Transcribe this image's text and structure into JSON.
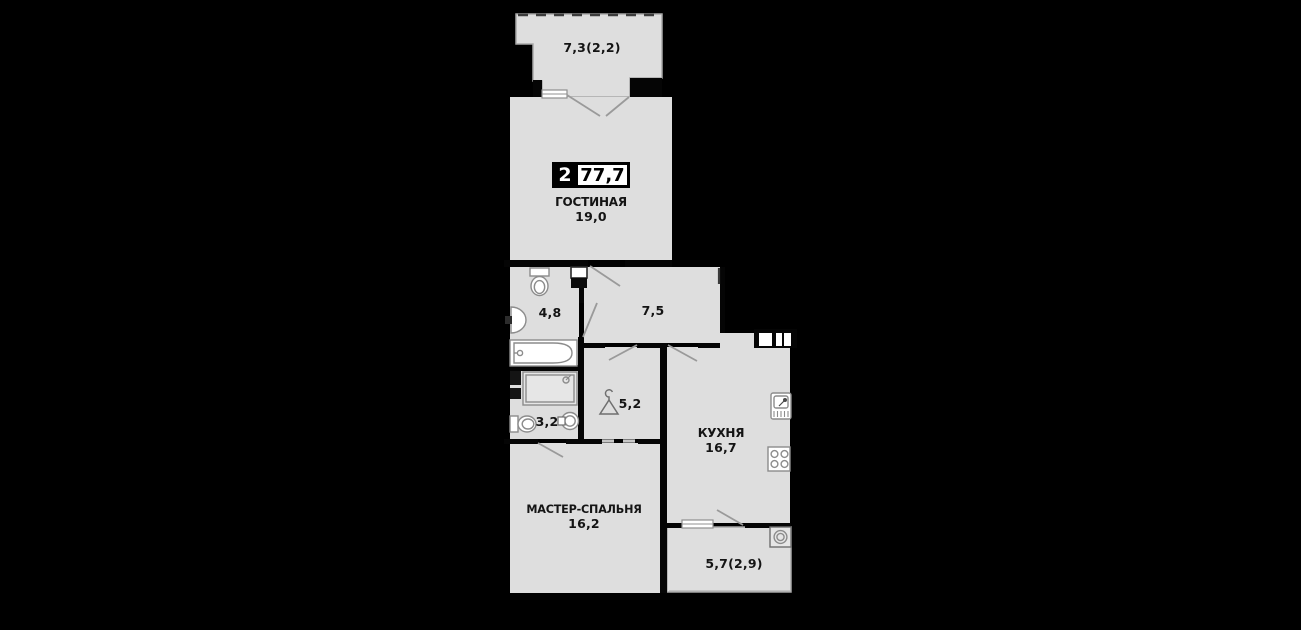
{
  "title_badge": {
    "rooms_count": "2",
    "total_area": "77,7"
  },
  "rooms": {
    "balcony_top": {
      "area": "7,3(2,2)",
      "fixtures": [
        "french-window"
      ]
    },
    "living": {
      "name": "ГОСТИНАЯ",
      "area": "19,0"
    },
    "bathroom": {
      "area": "4,8",
      "fixtures": [
        "toilet",
        "sink",
        "bathtub",
        "vent-shaft"
      ]
    },
    "hallway": {
      "area": "7,5",
      "fixtures": [
        "entrance-door"
      ]
    },
    "shower_room": {
      "area": "3,2",
      "fixtures": [
        "shower-tray",
        "toilet",
        "sink",
        "water-heater"
      ]
    },
    "wardrobe": {
      "area": "5,2",
      "fixtures": [
        "hanger"
      ]
    },
    "kitchen": {
      "name": "КУХНЯ",
      "area": "16,7",
      "fixtures": [
        "kitchen-sink",
        "stove",
        "vent-shaft",
        "window"
      ]
    },
    "master_bedroom": {
      "name": "МАСТЕР-СПАЛЬНЯ",
      "area": "16,2"
    },
    "balcony_bottom": {
      "area": "5,7(2,9)",
      "fixtures": [
        "washing-machine"
      ]
    }
  },
  "colors": {
    "background": "#000000",
    "floor": "#dedede",
    "wall": "#050505",
    "fixture_line": "#8c8c8c",
    "label_text": "#141414",
    "badge_background": "#000000",
    "badge_text": "#ffffff",
    "area_box_background": "#ffffff",
    "area_box_text": "#000000"
  }
}
